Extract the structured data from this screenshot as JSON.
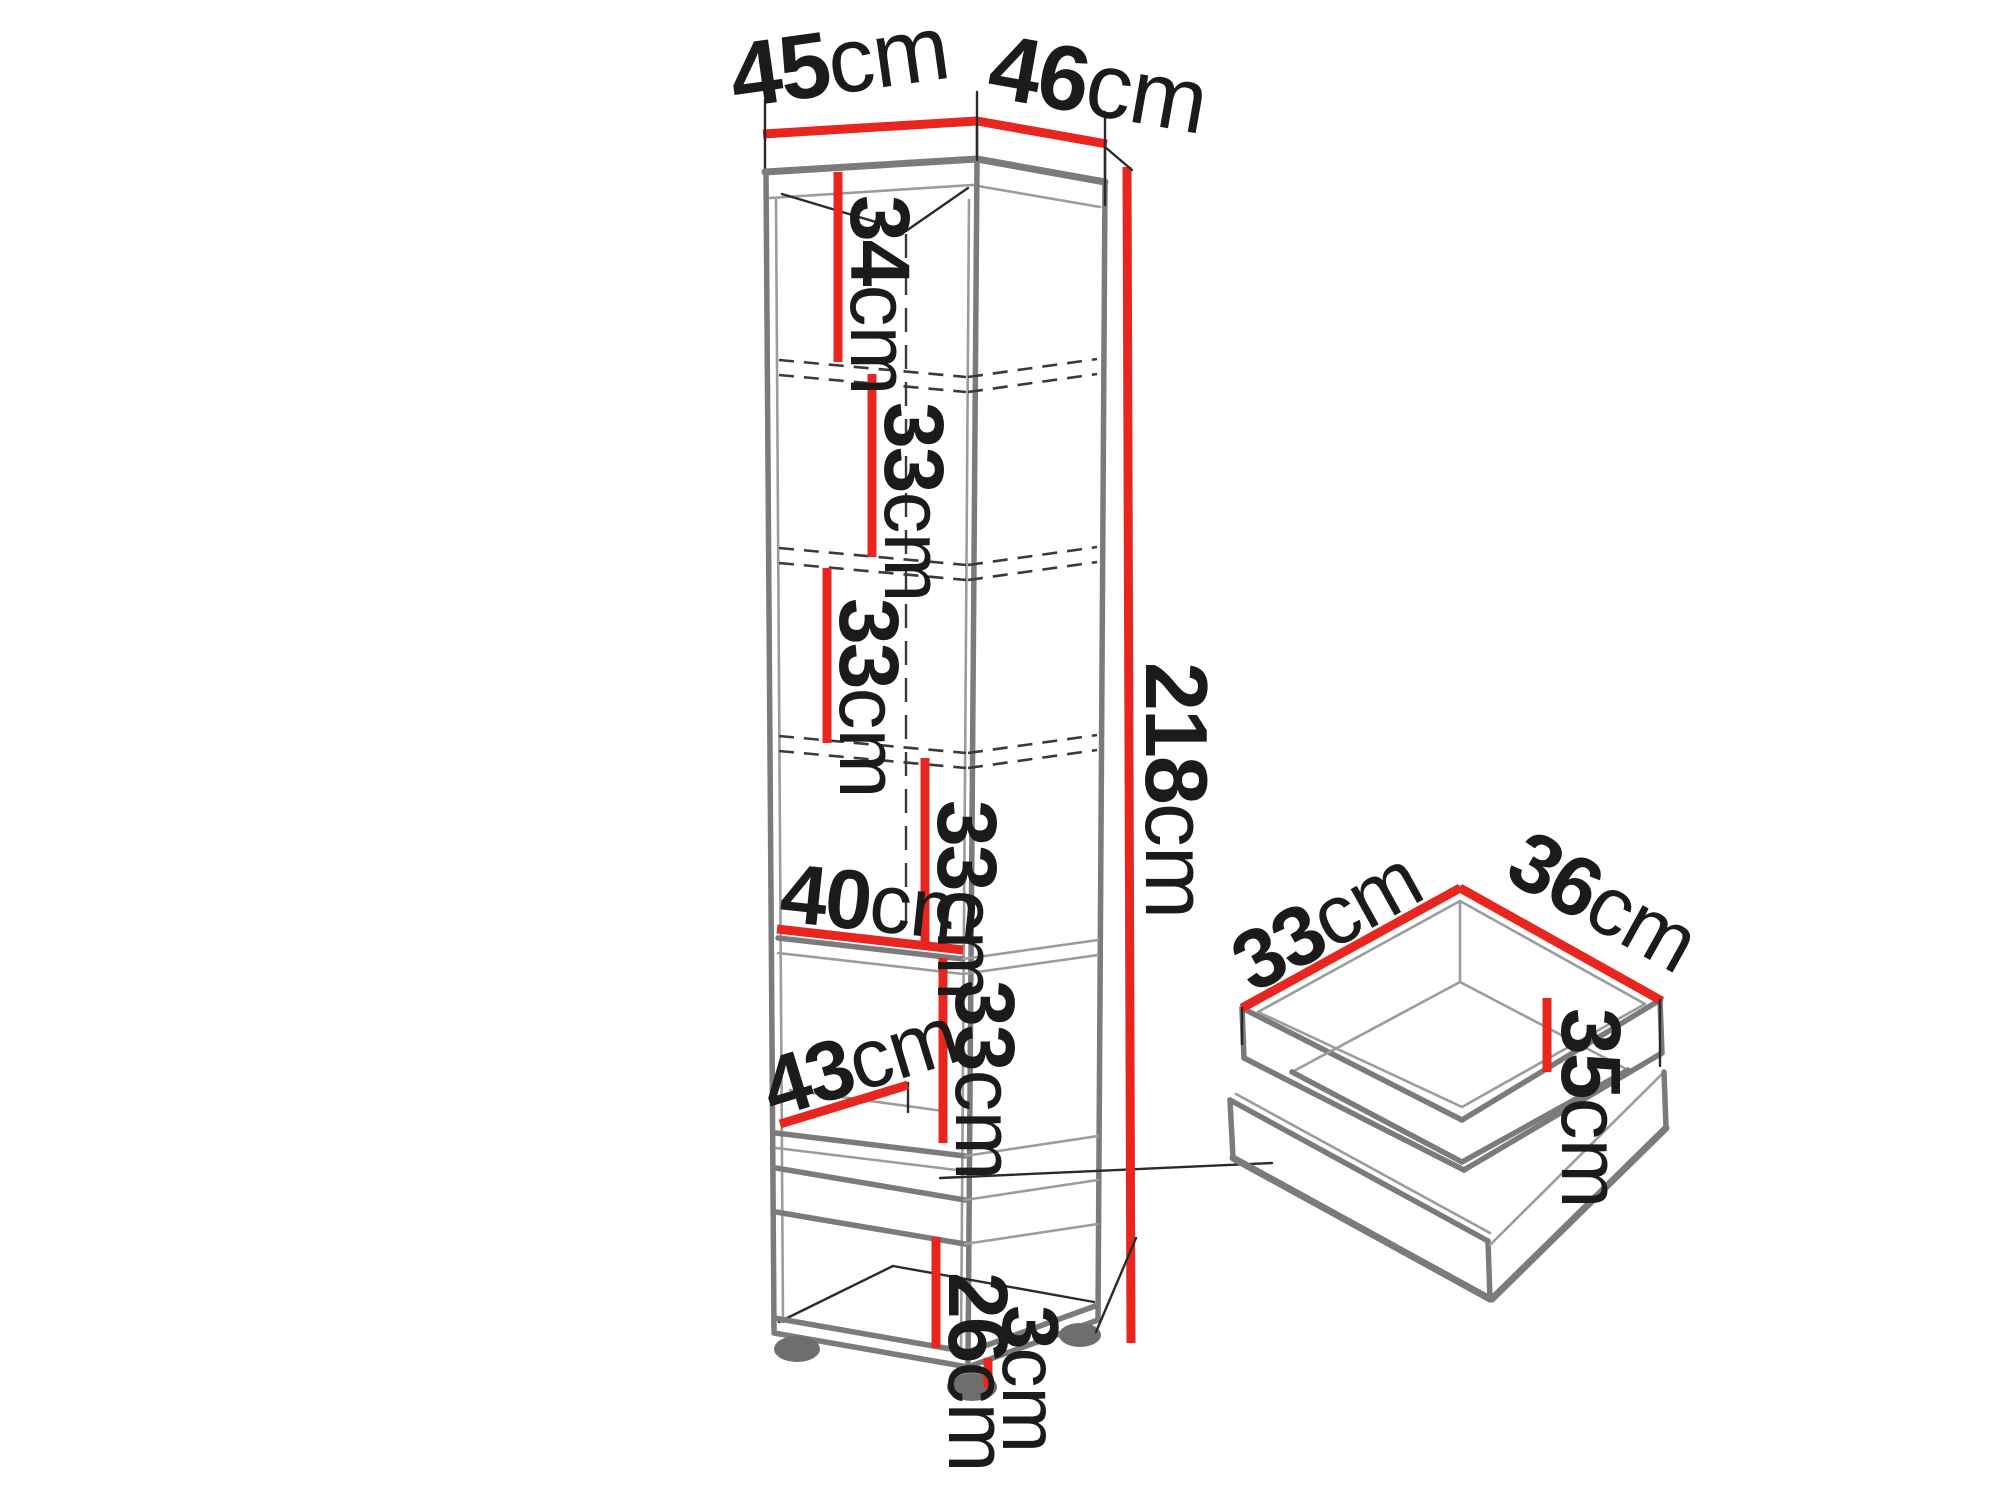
{
  "colors": {
    "dimension_red": "#e8251f",
    "line_gray": "#7b7b7b",
    "text_black": "#1b1b1b",
    "foot_gray": "#6e6e6e"
  },
  "cabinet": {
    "description": "tall cabinet with open shelves, drawer and feet",
    "top_width": {
      "value": "45",
      "unit": "cm"
    },
    "top_depth": {
      "value": "46",
      "unit": "cm"
    },
    "height": {
      "value": "218",
      "unit": "cm"
    },
    "sections": [
      {
        "value": "34",
        "unit": "cm"
      },
      {
        "value": "33",
        "unit": "cm"
      },
      {
        "value": "33",
        "unit": "cm"
      },
      {
        "value": "33",
        "unit": "cm"
      },
      {
        "value": "33",
        "unit": "cm"
      },
      {
        "value": "26",
        "unit": "cm"
      }
    ],
    "shelf_inner_width": {
      "value": "40",
      "unit": "cm"
    },
    "shelf_inner_depth": {
      "value": "43",
      "unit": "cm"
    },
    "feet_height": {
      "value": "3",
      "unit": "cm"
    }
  },
  "drawer": {
    "description": "open drawer box",
    "inner_width": {
      "value": "33",
      "unit": "cm"
    },
    "inner_depth": {
      "value": "36",
      "unit": "cm"
    },
    "inner_height": {
      "value": "35",
      "unit": "cm"
    }
  }
}
